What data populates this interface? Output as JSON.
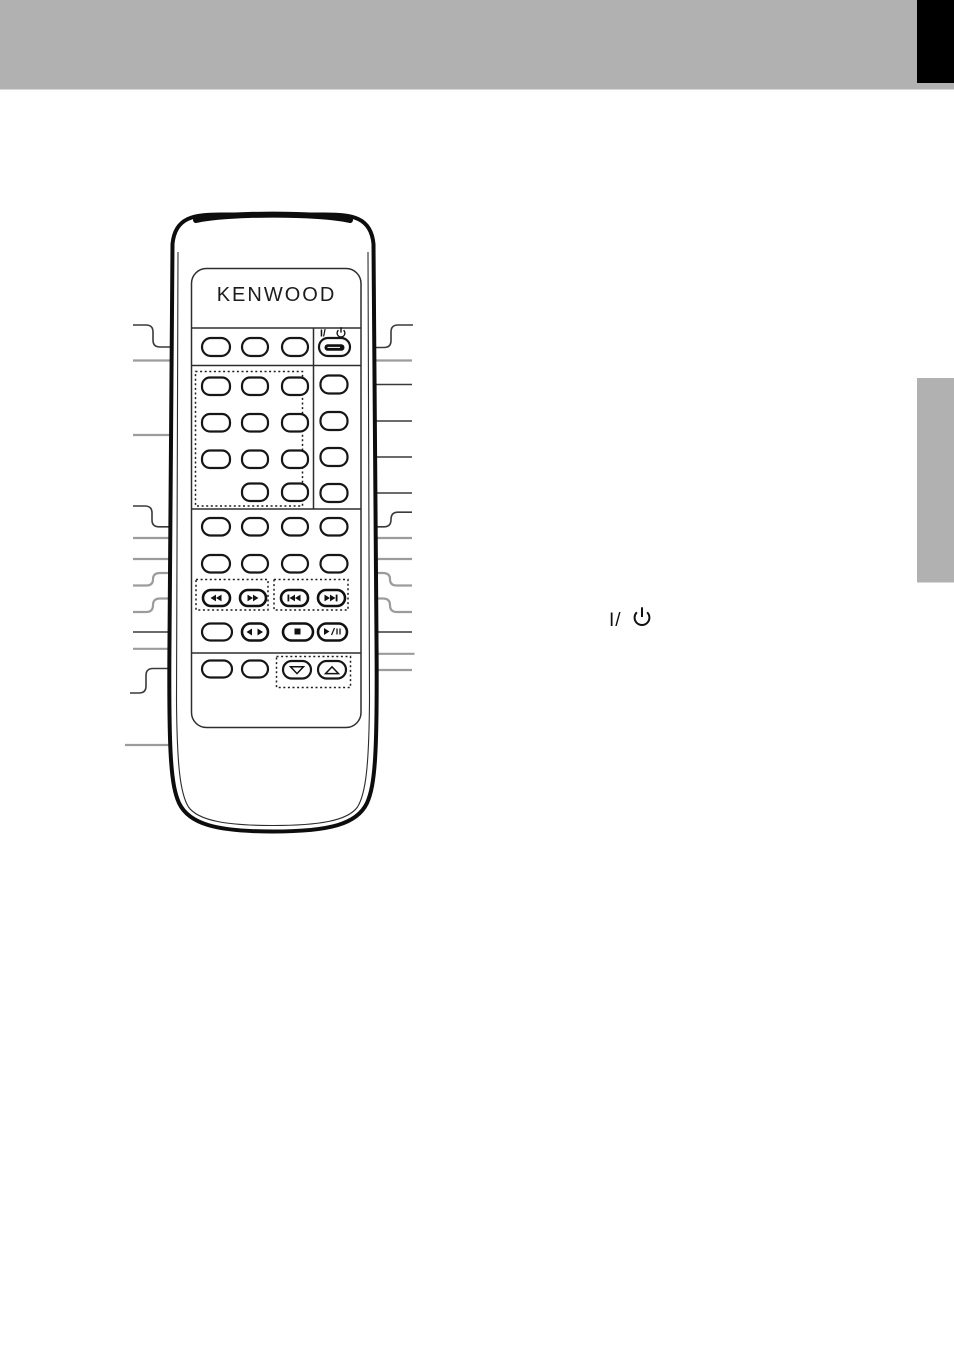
{
  "page": {
    "width": 954,
    "height": 1350,
    "background": "#ffffff"
  },
  "decor": {
    "top_bar_color": "#b1b1b1",
    "corner_tab_color": "#000000",
    "side_tab_color": "#b1b1b1"
  },
  "remote": {
    "brand": "KENWOOD",
    "power_label": "I/",
    "icons": {
      "power": "standby-power-icon (circle with vertical bar)",
      "rewind": "double-left-triangles",
      "fast_forward": "double-right-triangles",
      "previous_track": "bar-plus-double-left-triangles",
      "next_track": "double-right-triangles-plus-bar",
      "tuning_mode": "left-and-right-triangles",
      "stop": "filled-square",
      "play_pause": "triangle-slash-pause-bars",
      "down": "outline-triangle-down",
      "up": "outline-triangle-up"
    }
  },
  "annotation": {
    "power_symbol_label": "I/"
  }
}
